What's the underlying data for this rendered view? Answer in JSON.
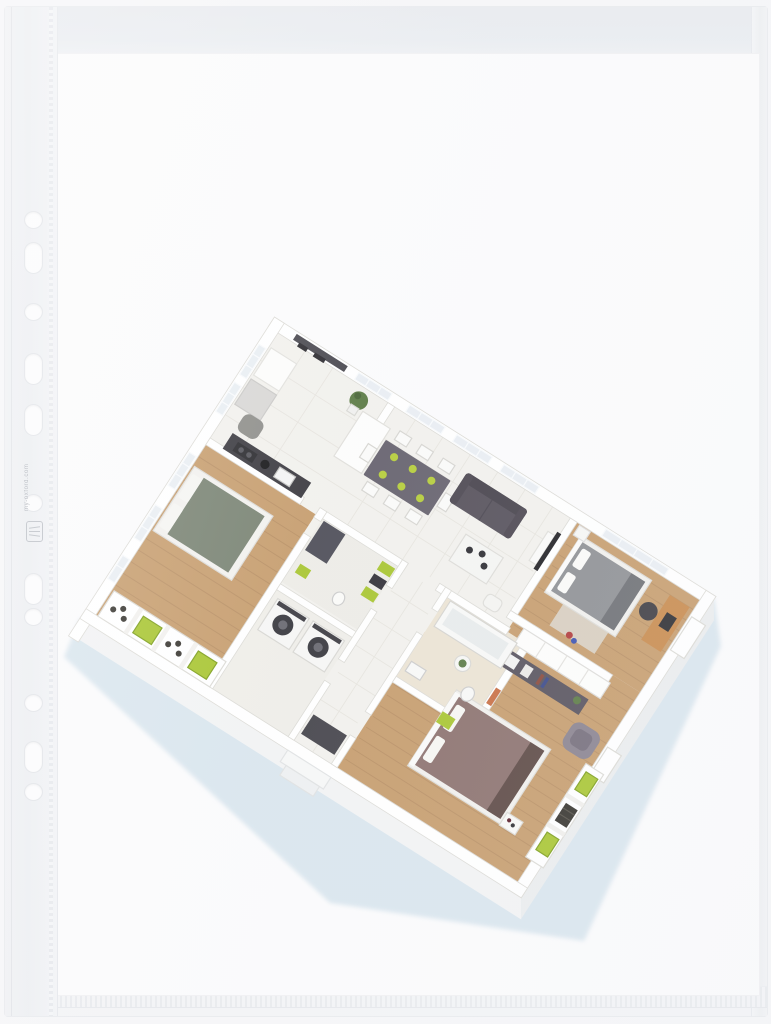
{
  "scene": {
    "description": "Clear punched pocket (sheet protector) containing a printed 3D isometric floor plan",
    "background_color": "#f5f5f7"
  },
  "pocket": {
    "hole_count": 11,
    "edge_microprint": "my-oxford.com",
    "plastic_tint": "#eef0f3",
    "seam_tint": "#e6e9ec"
  },
  "sheet": {
    "paper_color": "#fbfbfc"
  },
  "floor_plan": {
    "style": "isometric 3D cutaway apartment render",
    "rooms": [
      {
        "name": "kitchen",
        "floor": "light tile",
        "items": [
          "dark wall shelf",
          "tall white cabinet",
          "fridge",
          "dark counter with sink and hob",
          "grey chair",
          "potted plant"
        ]
      },
      {
        "name": "living-dining",
        "floor": "light tile",
        "items": [
          "dark dining table with white chairs and green plates",
          "dark grey sofa",
          "white coffee table with bowls",
          "TV partition wall",
          "white pouf"
        ]
      },
      {
        "name": "bedroom-top-right",
        "floor": "wood",
        "items": [
          "grey double bed",
          "white pillows",
          "wooden desk",
          "black desk chair",
          "beige rug"
        ]
      },
      {
        "name": "bedroom-left",
        "floor": "wood",
        "items": [
          "sage green double bed",
          "white pillows",
          "wall niches with green boxes and bottles"
        ]
      },
      {
        "name": "bedroom-bottom-right",
        "floor": "wood",
        "items": [
          "mauve double bed",
          "grey armchair",
          "dark shelf unit",
          "white sliding wardrobe",
          "side table with plant",
          "wall niches with green boxes and wine rack"
        ]
      },
      {
        "name": "bathroom-small",
        "floor": "tile",
        "items": [
          "dark shower mat",
          "wall shelf with green boxes",
          "toilet"
        ]
      },
      {
        "name": "laundry",
        "floor": "tile",
        "items": [
          "washing machine",
          "tumble dryer"
        ]
      },
      {
        "name": "bathroom-with-tub",
        "floor": "beige tile",
        "items": [
          "bathtub",
          "toilet",
          "sink"
        ]
      },
      {
        "name": "hallway",
        "floor": "tile",
        "items": [
          "dark doormat",
          "entry steps"
        ]
      }
    ],
    "colors": {
      "wood_floor": "#c79e6f",
      "tile_floor": "#f2f1ed",
      "wall": "#ffffff",
      "sofa": "#57525c",
      "dining_table": "#67636f",
      "bed_left": "#7a8474",
      "bed_right": "#8f9195",
      "bed_bottom": "#8d7370",
      "accent_green": "#a9c633",
      "desk_wood": "#c98c4f",
      "shadow_blue": "#d7e4ed",
      "dark_fixture": "#3b3a40",
      "plant_green": "#5d7c46",
      "glass": "#e9eef3"
    }
  }
}
